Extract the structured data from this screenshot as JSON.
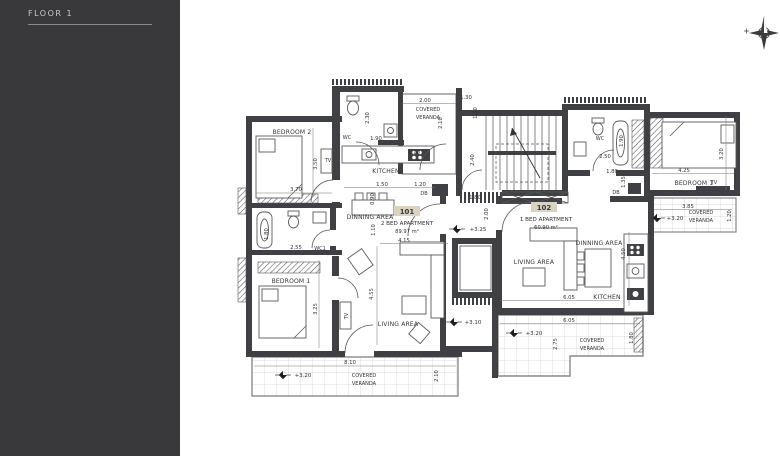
{
  "sidebar": {
    "title": "FLOOR 1"
  },
  "apartments": {
    "a101": {
      "number": "101",
      "type": "2 BED APARTMENT",
      "area": "89.97 m²"
    },
    "a102": {
      "number": "102",
      "type": "1 BED APARTMENT",
      "area": "60.90 m²"
    }
  },
  "rooms": {
    "bedroom1": "BEDROOM 1",
    "bedroom2": "BEDROOM 2",
    "kitchen": "KITCHEN",
    "dinning": "DINNING AREA",
    "living": "LIVING AREA",
    "wc": "WC",
    "wc1": "WC1",
    "covered": "COVERED",
    "veranda": "VERANDA",
    "tv": "TV",
    "db": "DB"
  },
  "levels": {
    "l325": "+3.25",
    "l320": "+3.20",
    "l310": "+3.10"
  },
  "dims": {
    "d090": "0.90",
    "d110": "1.10",
    "d120": "1.20",
    "d130": "1.30",
    "d135": "1.35",
    "d150": "1.50",
    "d180": "1.80",
    "d190": "1.90",
    "d200": "2.00",
    "d210": "2.10",
    "d230": "2.30",
    "d240": "2.40",
    "d250": "2.50",
    "d255": "2.55",
    "d275": "2.75",
    "d320": "3.20",
    "d325": "3.25",
    "d350": "3.50",
    "d370": "3.70",
    "d385": "3.85",
    "d415": "4.15",
    "d425": "4.25",
    "d450": "4.50",
    "d455": "4.55",
    "d605": "6.05",
    "d810": "8.10"
  }
}
